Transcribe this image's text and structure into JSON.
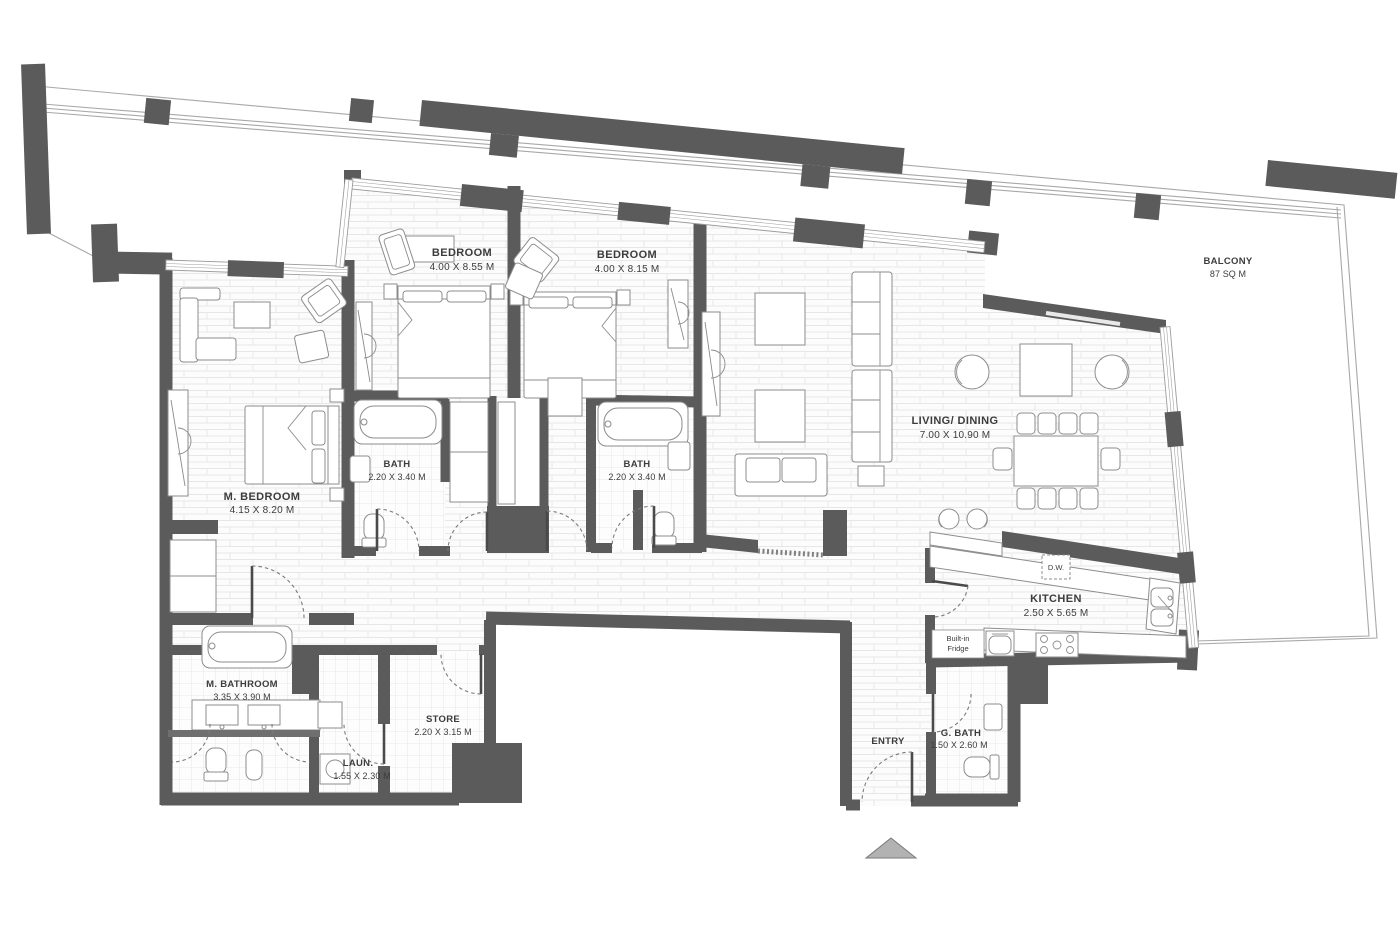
{
  "rooms": {
    "bedroom1": {
      "name": "BEDROOM",
      "dims": "4.00 X 8.55 M"
    },
    "bedroom2": {
      "name": "BEDROOM",
      "dims": "4.00 X 8.15 M"
    },
    "master_bedroom": {
      "name": "M. BEDROOM",
      "dims": "4.15 X 8.20 M"
    },
    "bath1": {
      "name": "BATH",
      "dims": "2.20 X 3.40 M"
    },
    "bath2": {
      "name": "BATH",
      "dims": "2.20 X 3.40 M"
    },
    "living_dining": {
      "name": "LIVING/ DINING",
      "dims": "7.00 X 10.90 M"
    },
    "kitchen": {
      "name": "KITCHEN",
      "dims": "2.50 X 5.65 M"
    },
    "master_bathroom": {
      "name": "M. BATHROOM",
      "dims": "3.35 X 3.90 M"
    },
    "laundry": {
      "name": "LAUN.",
      "dims": "1.55 X 2.30 M"
    },
    "store": {
      "name": "STORE",
      "dims": "2.20 X 3.15 M"
    },
    "guest_bath": {
      "name": "G. BATH",
      "dims": "1.50 X 2.60 M"
    },
    "entry": {
      "name": "ENTRY"
    },
    "balcony": {
      "name": "BALCONY",
      "dims": "87 SQ M"
    }
  },
  "annotations": {
    "dishwasher": "D.W.",
    "fridge_line1": "Built-in",
    "fridge_line2": "Fridge"
  },
  "colors": {
    "wall": "#5b5b5b",
    "furniture": "#8c8c8c",
    "label": "#3c3c3c",
    "outline": "#a8a8a8",
    "door": "#7a7a7a"
  }
}
